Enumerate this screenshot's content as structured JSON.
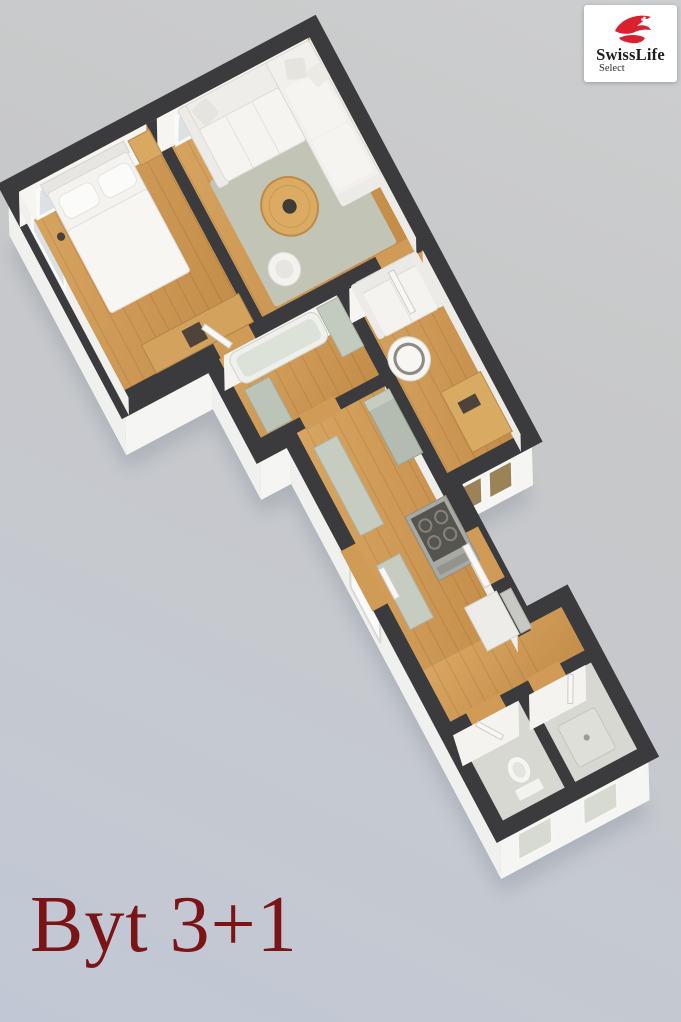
{
  "caption": {
    "text": "Byt 3+1",
    "color": "#7a1417"
  },
  "logo": {
    "brand": "SwissLife",
    "subbrand": "Select",
    "accent_color": "#d8202f",
    "text_color": "#1e1e1c",
    "background": "#ffffff"
  },
  "scene": {
    "type": "3d-floorplan-render",
    "background_top": "#cdcecf",
    "background_bottom": "#c1c8d5",
    "wall_top_color": "#3b3b3d",
    "wall_face_color": "#f2f2f0",
    "floor_wood_color": "#cf9c58",
    "rug_color": "#c2c4b5",
    "fixture_color": "#c6cbc0",
    "rooms": [
      "bedroom",
      "living-room",
      "sitting-room",
      "bathroom",
      "kitchen-corridor",
      "hallway",
      "wc",
      "shower-room"
    ]
  }
}
